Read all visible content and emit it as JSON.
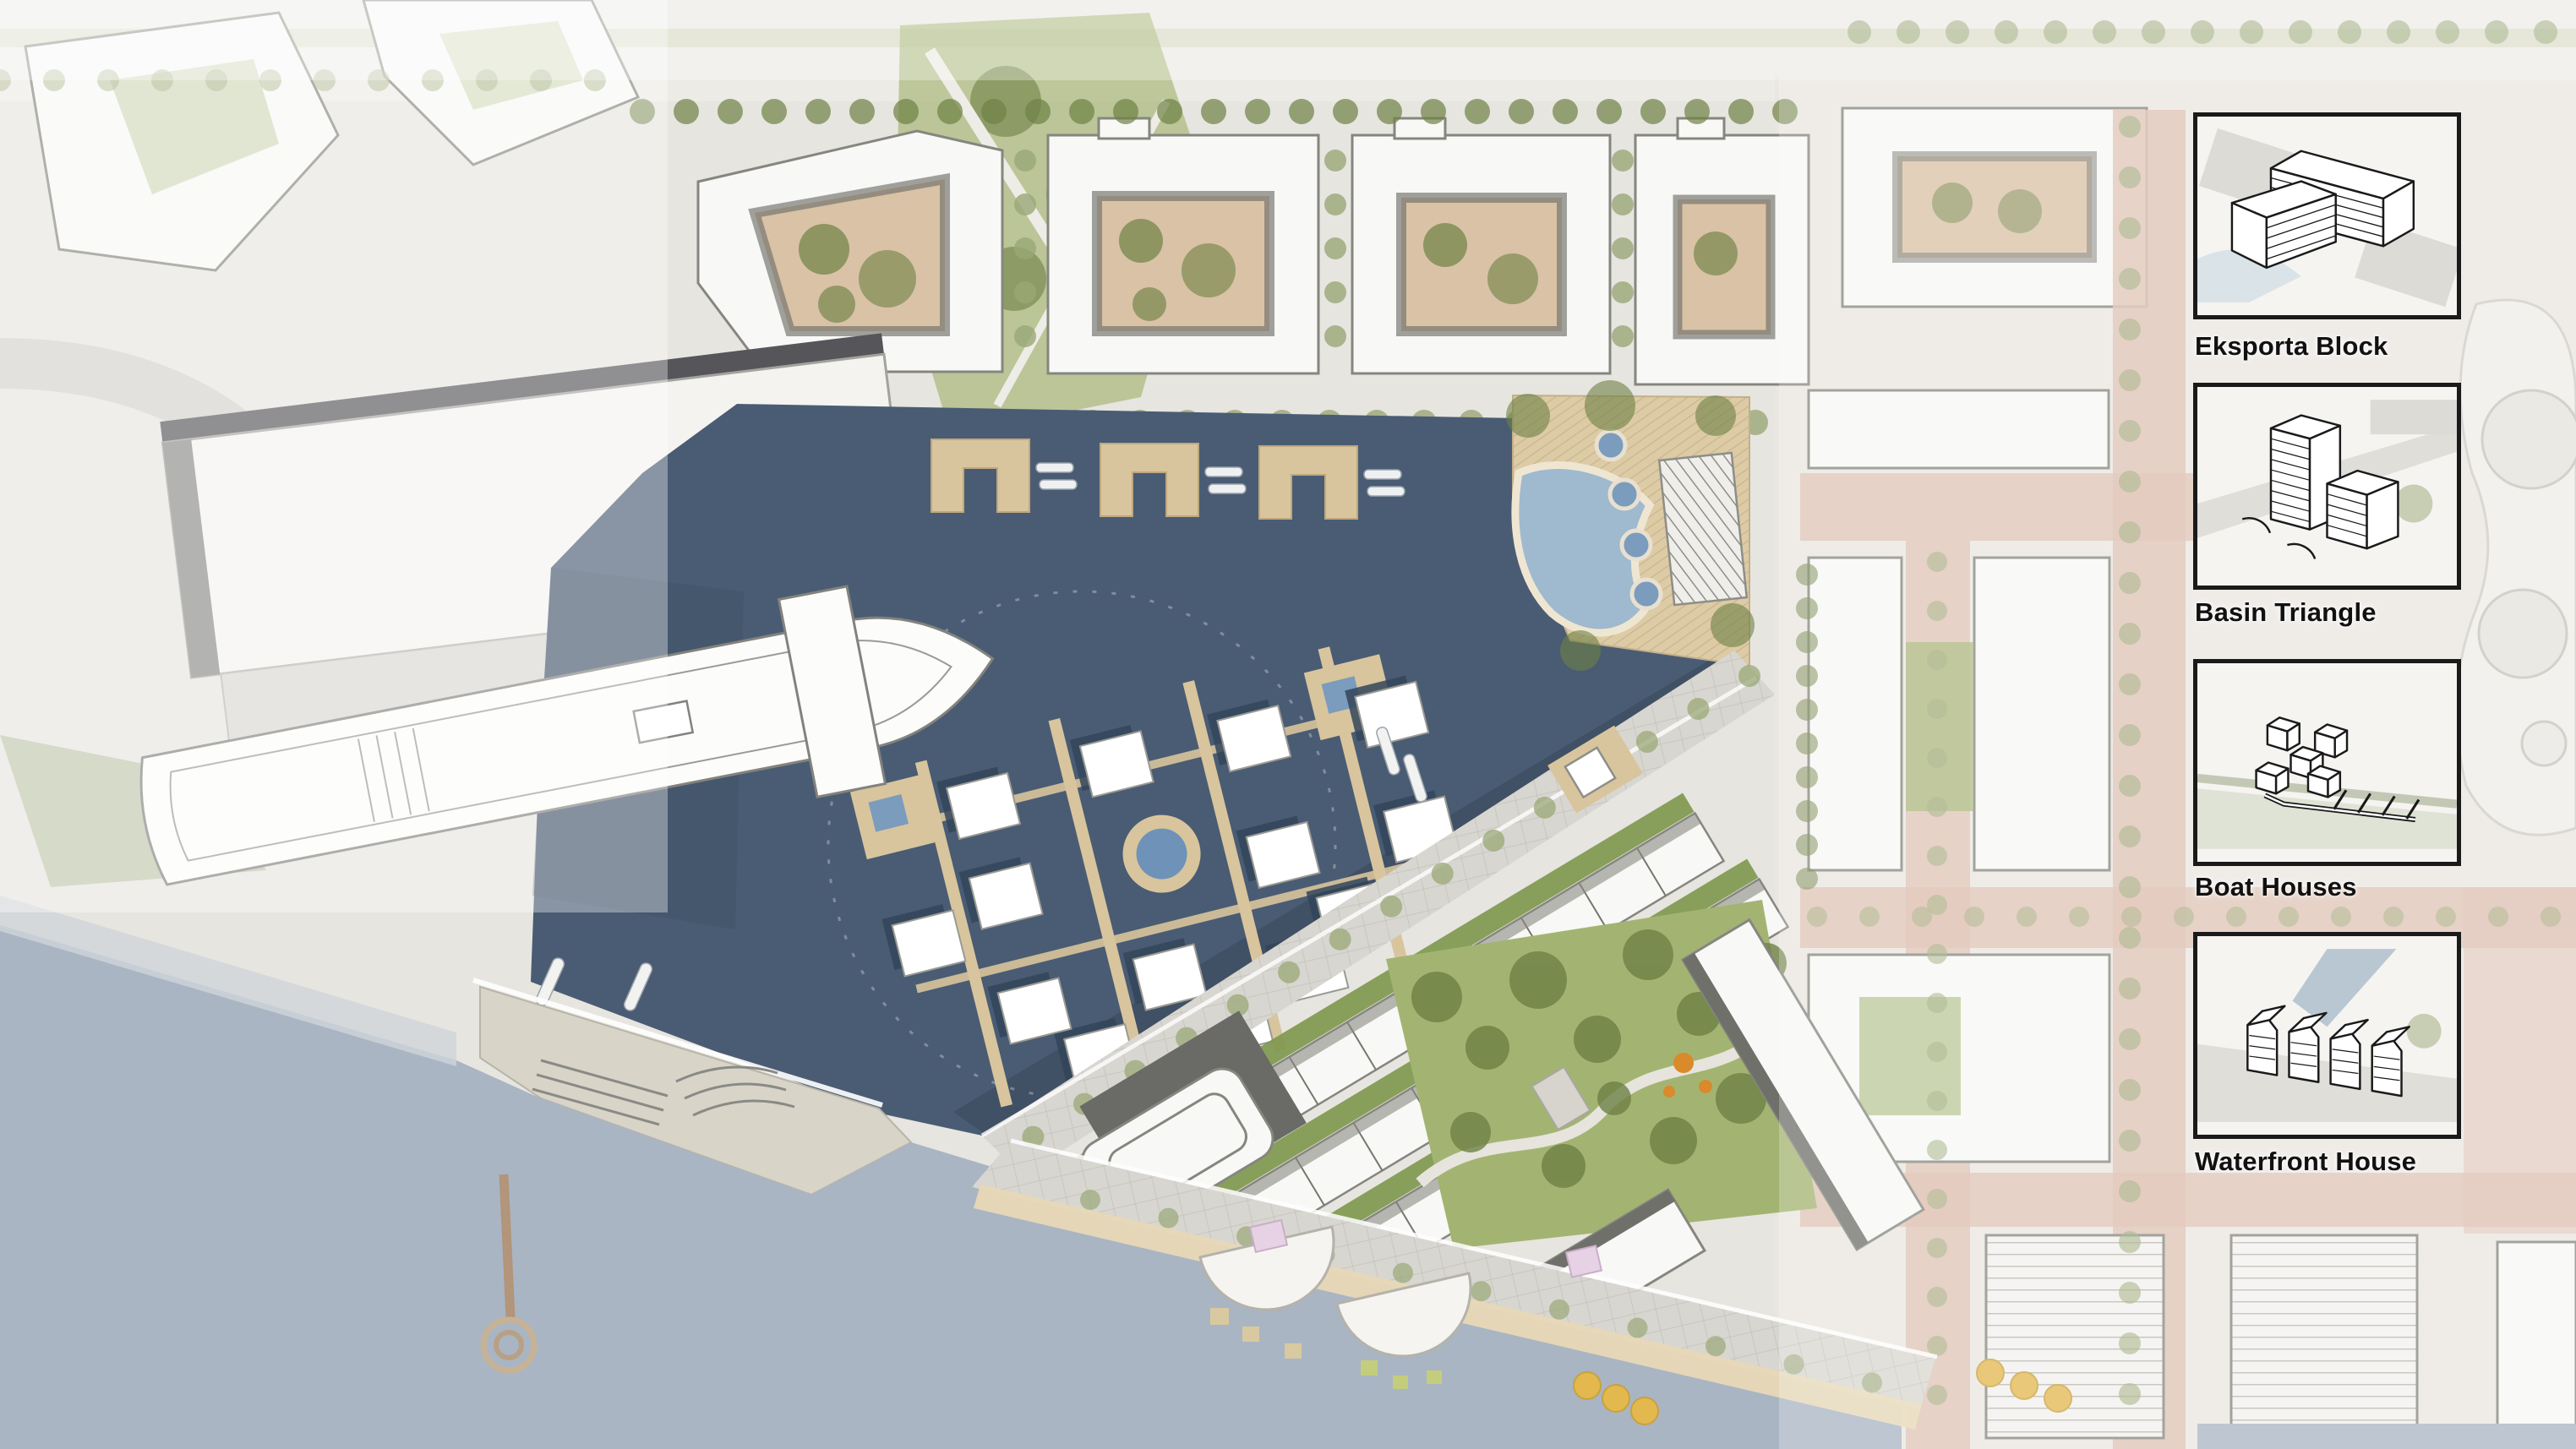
{
  "legend": {
    "items": [
      {
        "label": "Eksporta Block",
        "icon": "perimeter-block-axon"
      },
      {
        "label": "Basin Triangle",
        "icon": "towers-axon"
      },
      {
        "label": "Boat Houses",
        "icon": "boat-houses-axon"
      },
      {
        "label": "Waterfront House",
        "icon": "gabled-row-axon"
      }
    ]
  },
  "colors": {
    "land": "#e7e5e0",
    "land_light": "#edebe6",
    "land_pink": "#eae6e1",
    "water_dark": "#4a5c73",
    "water_dark_edge": "#3d4e62",
    "water_light": "#a9b5c3",
    "dock": "#d8c59d",
    "sand": "#e7d8b6",
    "deck": "#ddcba6",
    "building": "#f8f8f6",
    "building_line": "#86867f",
    "shadow": "#6f6f6a",
    "roof_dark": "#55555a",
    "road": "#dcd9d3",
    "promenade": "#d8d6d0",
    "terracotta": "#dcbcab",
    "terracotta_deep": "#cfa18c",
    "lawn": "#a3b472",
    "tree_sage": "#9aa877",
    "tree_dark": "#6e8145",
    "hedge": "#7d974d",
    "courtyard_tan": "#d9c2a6",
    "pool": "#9fb9cf",
    "tub": "#7b9cbd",
    "pergola": "#c9c6bf",
    "parasol": "#e2b84f",
    "lilac": "#e7d2e5",
    "orange": "#d98a2b",
    "pier": "#d8d4c8",
    "jetty": "#b2957a",
    "ink": "#1a1a1a",
    "panel_bg": "#f5f4f1"
  }
}
